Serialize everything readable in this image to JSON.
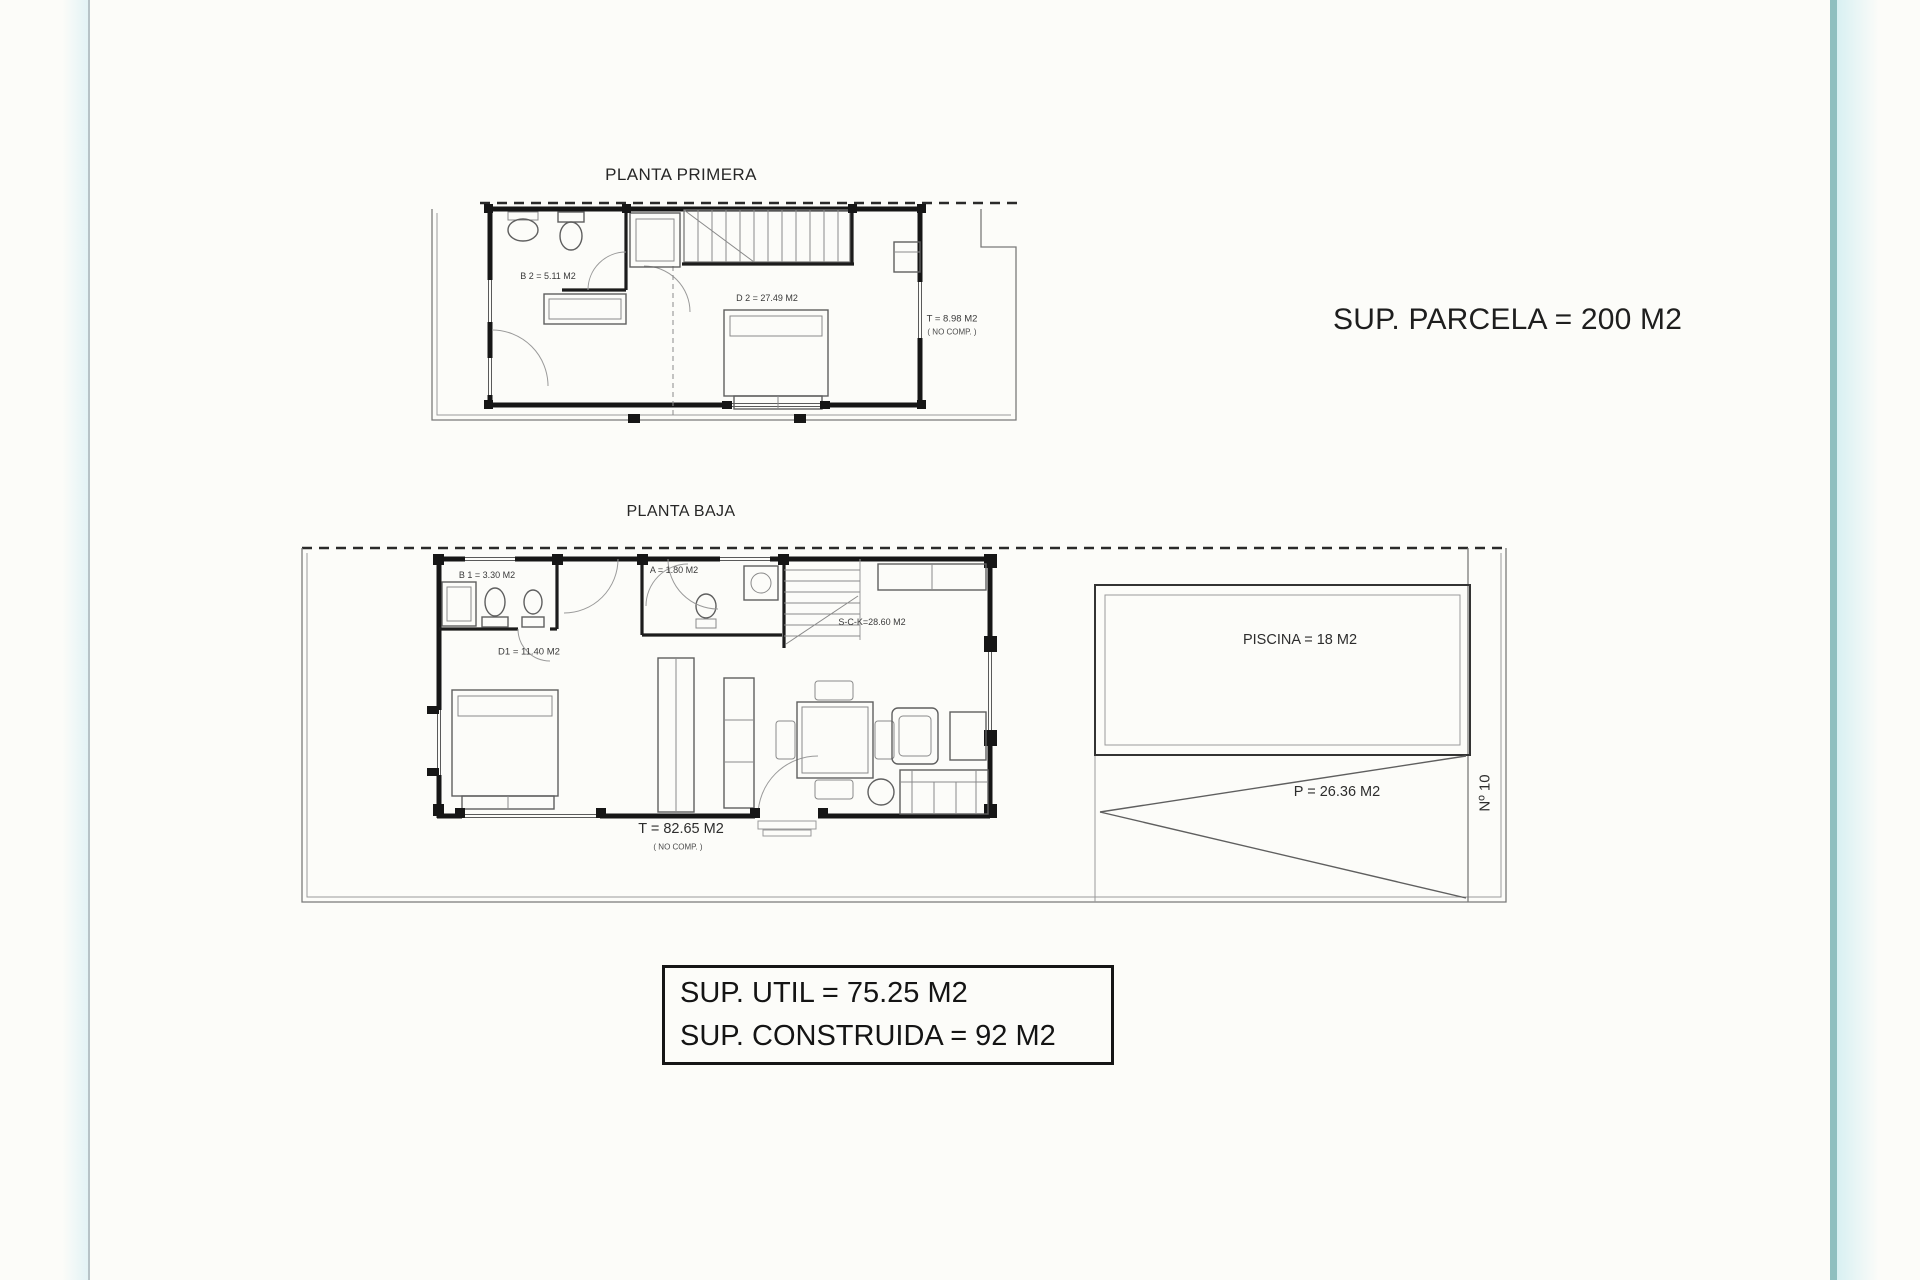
{
  "plans": {
    "first_floor": {
      "title": "PLANTA PRIMERA",
      "labels": {
        "bathroom": "B 2 = 5.11 M2",
        "bedroom": "D 2 = 27.49 M2",
        "terrace": "T = 8.98 M2",
        "terrace_note": "( NO COMP. )"
      }
    },
    "ground_floor": {
      "title": "PLANTA BAJA",
      "labels": {
        "bathroom": "B 1 = 3.30 M2",
        "laundry": "A = 1.80 M2",
        "bedroom": "D1 = 11.40 M2",
        "living_kitchen": "S-C-K=28.60 M2",
        "terrace": "T = 82.65 M2",
        "terrace_note": "( NO COMP. )",
        "pool": "PISCINA = 18 M2",
        "parking": "P = 26.36 M2",
        "street_number": "Nº 10"
      }
    }
  },
  "annotations": {
    "parcel_area": "SUP. PARCELA = 200 M2",
    "useful_area": "SUP. UTIL = 75.25 M2",
    "built_area": "SUP. CONSTRUIDA = 92 M2"
  },
  "colors": {
    "accent_teal": "#8fbfbf",
    "wall_line": "#161616",
    "paper": "#fcfcf9"
  }
}
